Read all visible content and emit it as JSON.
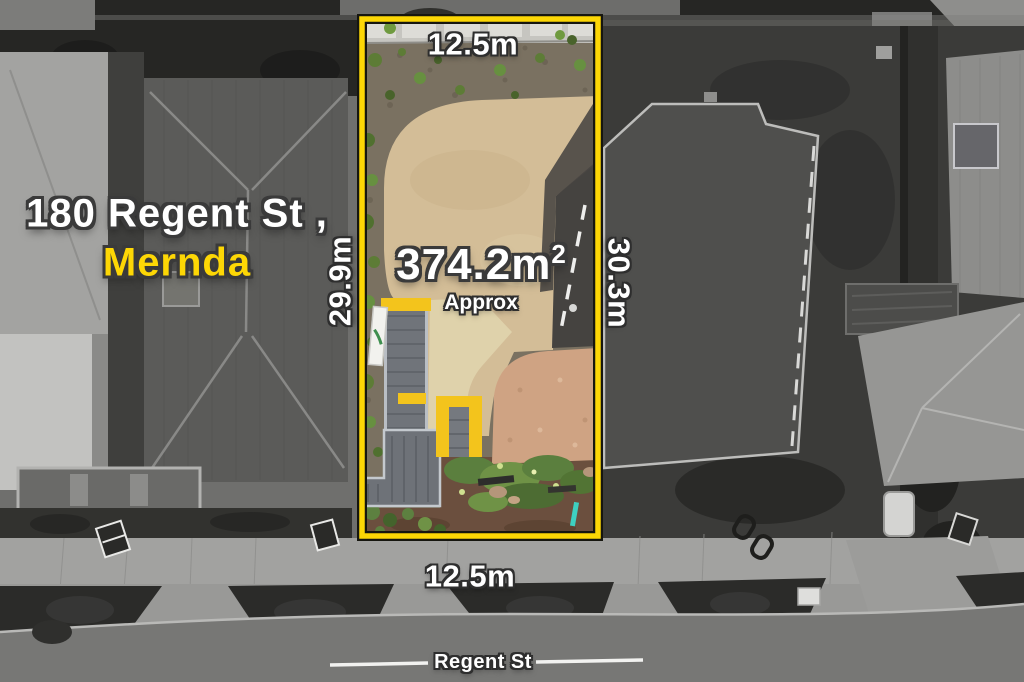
{
  "title": {
    "line1": "180 Regent St ,",
    "line2": "Mernda"
  },
  "lot": {
    "width_top": "12.5m",
    "width_bottom": "12.5m",
    "depth_left": "29.9m",
    "depth_right": "30.3m",
    "area_value": "374.2m",
    "area_sup": "2",
    "area_qualifier": "Approx"
  },
  "street": {
    "label": "Regent St"
  },
  "colors": {
    "accent_yellow": "#fdd705",
    "boundary_outline": "#16160f",
    "text_white": "#ffffff",
    "text_outline": "#3a3a3a"
  }
}
